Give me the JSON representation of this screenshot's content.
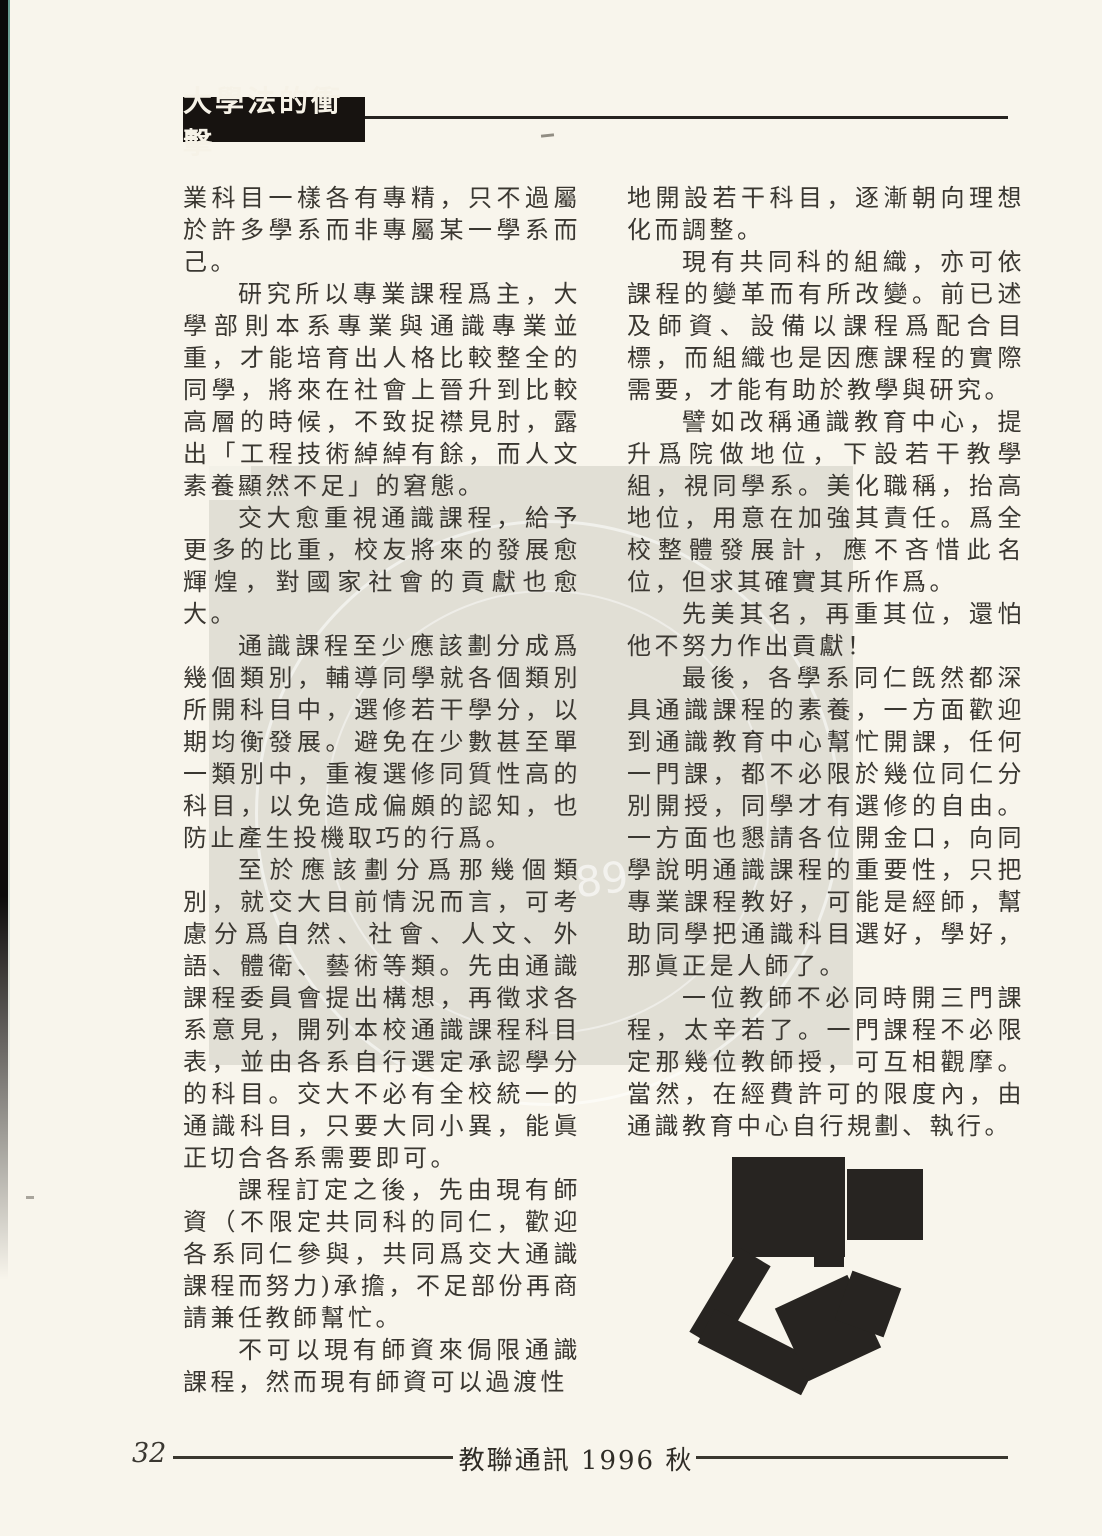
{
  "header": {
    "title": "大學法的衝擊"
  },
  "article": {
    "left_column_paragraphs": [
      "業科目一樣各有專精，只不過屬於許多學系而非專屬某一學系而己。",
      "研究所以專業課程爲主，大學部則本系專業與通識專業並重，才能培育出人格比較整全的同學，將來在社會上晉升到比較高層的時候，不致捉襟見肘，露出「工程技術綽綽有餘，而人文素養顯然不足」的窘態。",
      "交大愈重視通識課程，給予更多的比重，校友將來的發展愈輝煌，對國家社會的貢獻也愈大。",
      "通識課程至少應該劃分成爲幾個類別，輔導同學就各個類別所開科目中，選修若干學分，以期均衡發展。避免在少數甚至單一類別中，重複選修同質性高的科目，以免造成偏頗的認知，也防止產生投機取巧的行爲。",
      "至於應該劃分爲那幾個類別，就交大目前情況而言，可考慮分爲自然、社會、人文、外語、體衛、藝術等類。先由通識課程委員會提出構想，再徵求各系意見，開列本校通識課程科目表，並由各系自行選定承認學分的科目。交大不必有全校統一的通識科目，只要大同小異，能眞正切合各系需要即可。",
      "課程訂定之後，先由現有師資（不限定共同科的同仁，歡迎各系同仁參與，共同爲交大通識課程而努力)承擔，不足部份再商請兼任教師幫忙。",
      "不可以現有師資來侷限通識課程，然而現有師資可以過渡性"
    ],
    "right_column_paragraphs": [
      "地開設若干科目，逐漸朝向理想化而調整。",
      "現有共同科的組織，亦可依課程的變革而有所改變。前已述及師資、設備以課程爲配合目標，而組織也是因應課程的實際需要，才能有助於教學與研究。",
      "譬如改稱通識教育中心，提升爲院做地位，下設若干教學組，視同學系。美化職稱，抬高地位，用意在加強其責任。爲全校整體發展計，應不吝惜此名位，但求其確實其所作爲。",
      "先美其名，再重其位，還怕他不努力作出貢獻！",
      "最後，各學系同仁旣然都深具通識課程的素養，一方面歡迎到通識教育中心幫忙開課，任何一門課，都不必限於幾位同仁分別開授，同學才有選修的自由。一方面也懇請各位開金口，向同學說明通識課程的重要性，只把專業課程教好，可能是經師，幫助同學把通識科目選好，學好，那眞正是人師了。",
      "一位教師不必同時開三門課程，太辛若了。一門課程不必限定那幾位教師授，可互相觀摩。當然，在經費許可的限度內，由通識教育中心自行規劃、執行。"
    ]
  },
  "watermark": {
    "seal_text": "89"
  },
  "footer": {
    "page_number": "32",
    "journal_title": "教聯通訊 1996 秋"
  },
  "colors": {
    "page_background": "#f8f5ec",
    "ink": "#3a3731",
    "banner_background": "#171310",
    "banner_text": "#f6f2e7",
    "graphic_black": "#272421",
    "edge_teal": "#4d8d82",
    "watermark_gray": "#e2e0da"
  }
}
